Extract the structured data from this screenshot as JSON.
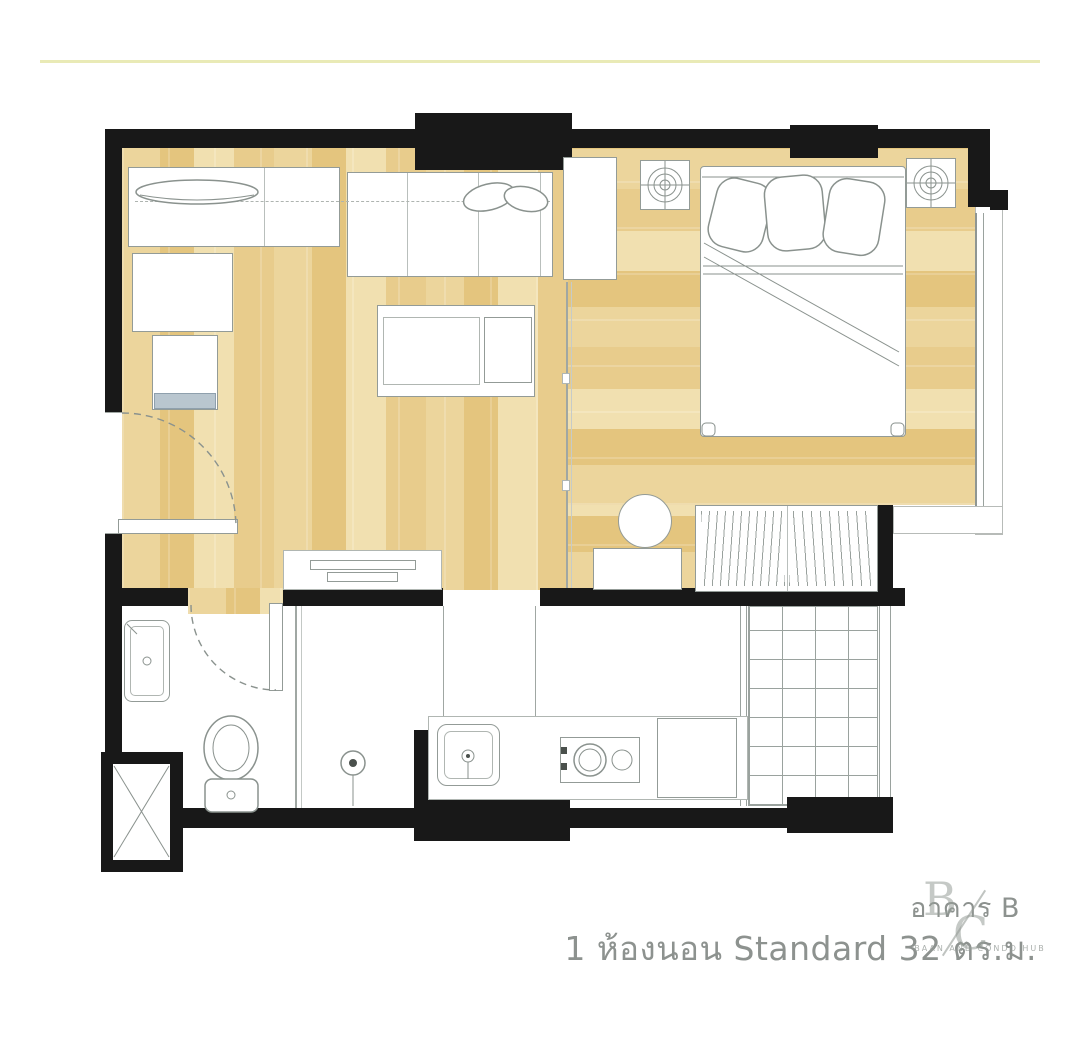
{
  "caption": {
    "building": "อาคาร B",
    "unit": "1 ห้องนอน Standard 32 ตร.ม."
  },
  "watermark": {
    "letter1": "B",
    "letter2": "C",
    "subtitle": "BAAN AND CONDO HUB"
  },
  "colors": {
    "wall": "#181818",
    "wood_light": "#f1e0b0",
    "wood_mid": "#ecd59c",
    "wood_dark": "#e4c57e",
    "outline_gray": "#8f9693",
    "caption_text": "#8d928f",
    "top_divider": "#e9eab6",
    "tv_screen": "#b9c6cf"
  },
  "fixtures": [
    "sofa-icon",
    "console-icon",
    "tv-icon",
    "coffee-table-icon",
    "bar-counter-icon",
    "entry-door-icon",
    "double-bed-icon",
    "nightstand-icon",
    "ceiling-lamp-icon",
    "wardrobe-icon",
    "stool-icon",
    "balcony-icon",
    "washbasin-icon",
    "toilet-icon",
    "shower-drain-icon",
    "service-shaft-icon",
    "kitchen-sink-icon",
    "cooktop-icon",
    "counter-icon",
    "drying-grid-icon"
  ]
}
